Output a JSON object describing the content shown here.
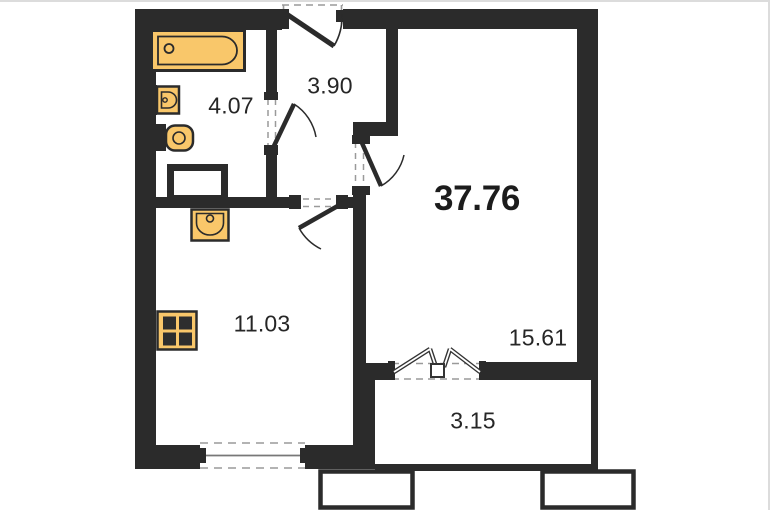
{
  "plan": {
    "total_area": "37.76",
    "rooms": [
      {
        "name": "bathroom",
        "area": "4.07"
      },
      {
        "name": "hallway",
        "area": "3.90"
      },
      {
        "name": "kitchen",
        "area": "11.03"
      },
      {
        "name": "living-room",
        "area": "15.61"
      },
      {
        "name": "balcony",
        "area": "3.15"
      }
    ],
    "fixtures": [
      "bathtub",
      "washbasin",
      "toilet",
      "ventilation-shaft",
      "kitchen-sink",
      "stove"
    ],
    "openings": [
      "entrance-door",
      "bathroom-door",
      "living-room-door",
      "kitchen-door",
      "balcony-french-door",
      "kitchen-window"
    ],
    "colors": {
      "walls": "#2b2b2b",
      "fixture_fill": "#f9c76a",
      "fixture_stroke": "#2b2b2b",
      "background": "#ffffff",
      "dashes": "#8f8f8f",
      "labels": "#262626"
    }
  }
}
